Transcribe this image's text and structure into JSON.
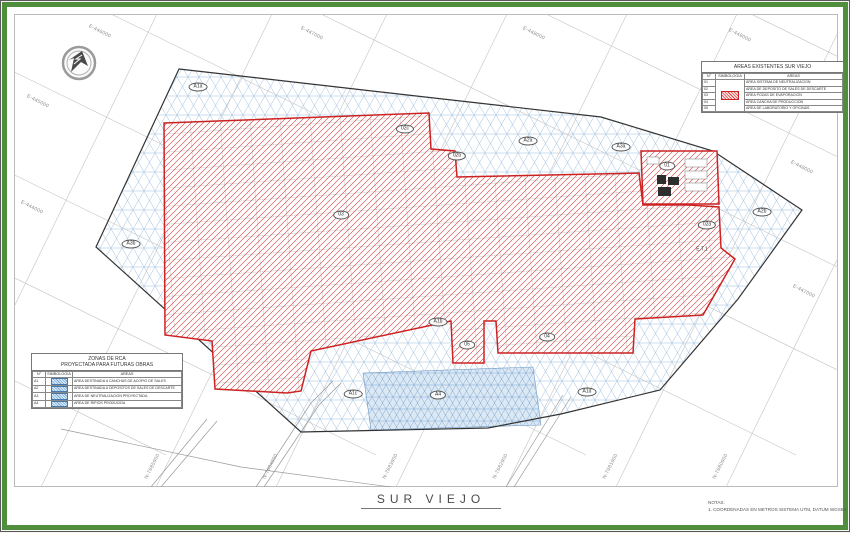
{
  "title": "SUR VIEJO",
  "notes": {
    "heading": "NOTAS:",
    "item1": "1.    COORDENADAS EN METROS SISTEMA UTM, DATUM WGS84."
  },
  "colors": {
    "frame_green": "#4e8e3d",
    "area_red": "#cc2222",
    "area_blue": "#8fb3d9",
    "grid_gray": "#c4c4c4"
  },
  "grid": {
    "top_labels": [
      "E-446000",
      "E-447000",
      "E-448000",
      "E-449000"
    ],
    "left_labels": [
      "E-445000",
      "E-444000"
    ],
    "right_labels": [
      "E-448000",
      "E-447000"
    ],
    "bottom_labels": [
      "N-7685900",
      "N-7684900",
      "N-7683900",
      "N-7682900",
      "N-7681900",
      "N-7680900"
    ]
  },
  "legend_existing": {
    "title": "AREAS EXISTENTES SUR VIEJO",
    "col_headers": [
      "N°",
      "SIMBOLOGIA",
      "AREAS"
    ],
    "rows": [
      {
        "n": "01",
        "area": "AREA SISTEMA DE NEUTRALIZACION"
      },
      {
        "n": "02",
        "area": "AREA DE DEPOSITO DE SALES DE DESCARTE"
      },
      {
        "n": "03",
        "area": "AREA POZAS DE EVAPORACION"
      },
      {
        "n": "04",
        "area": "AREA CANCHA DE PRODUCCION"
      },
      {
        "n": "05",
        "area": "AREA DE LABORATORIO Y OFICINAS"
      }
    ]
  },
  "legend_projected": {
    "title_line1": "ZONAS DE RCA",
    "title_line2": "PROYECTADA PARA FUTURAS OBRAS",
    "col_headers": [
      "N°",
      "SIMBOLOGIA",
      "AREAS"
    ],
    "rows": [
      {
        "n": "A1",
        "area": "AREA DESTINADA A CANCHAS DE ACOPIO DE SALES"
      },
      {
        "n": "A2",
        "area": "AREA DESTINADA A DEPOSITOS DE SALES DE DESCARTE"
      },
      {
        "n": "A3",
        "area": "AREA DE NEUTRALIZACION PROYECTADA"
      },
      {
        "n": "A4",
        "area": "AREA DE RIPIOS PRODUCIDA"
      }
    ]
  },
  "map_labels": [
    {
      "text": "A1a"
    },
    {
      "text": "02c"
    },
    {
      "text": "02b"
    },
    {
      "text": "A2a"
    },
    {
      "text": "A3a"
    },
    {
      "text": "01"
    },
    {
      "text": "A2b"
    },
    {
      "text": "02a"
    },
    {
      "text": "E.T.1"
    },
    {
      "text": "A3b"
    },
    {
      "text": "03"
    },
    {
      "text": "A1b"
    },
    {
      "text": "05"
    },
    {
      "text": "04"
    },
    {
      "text": "A1c"
    },
    {
      "text": "A4"
    },
    {
      "text": "A1d"
    }
  ]
}
